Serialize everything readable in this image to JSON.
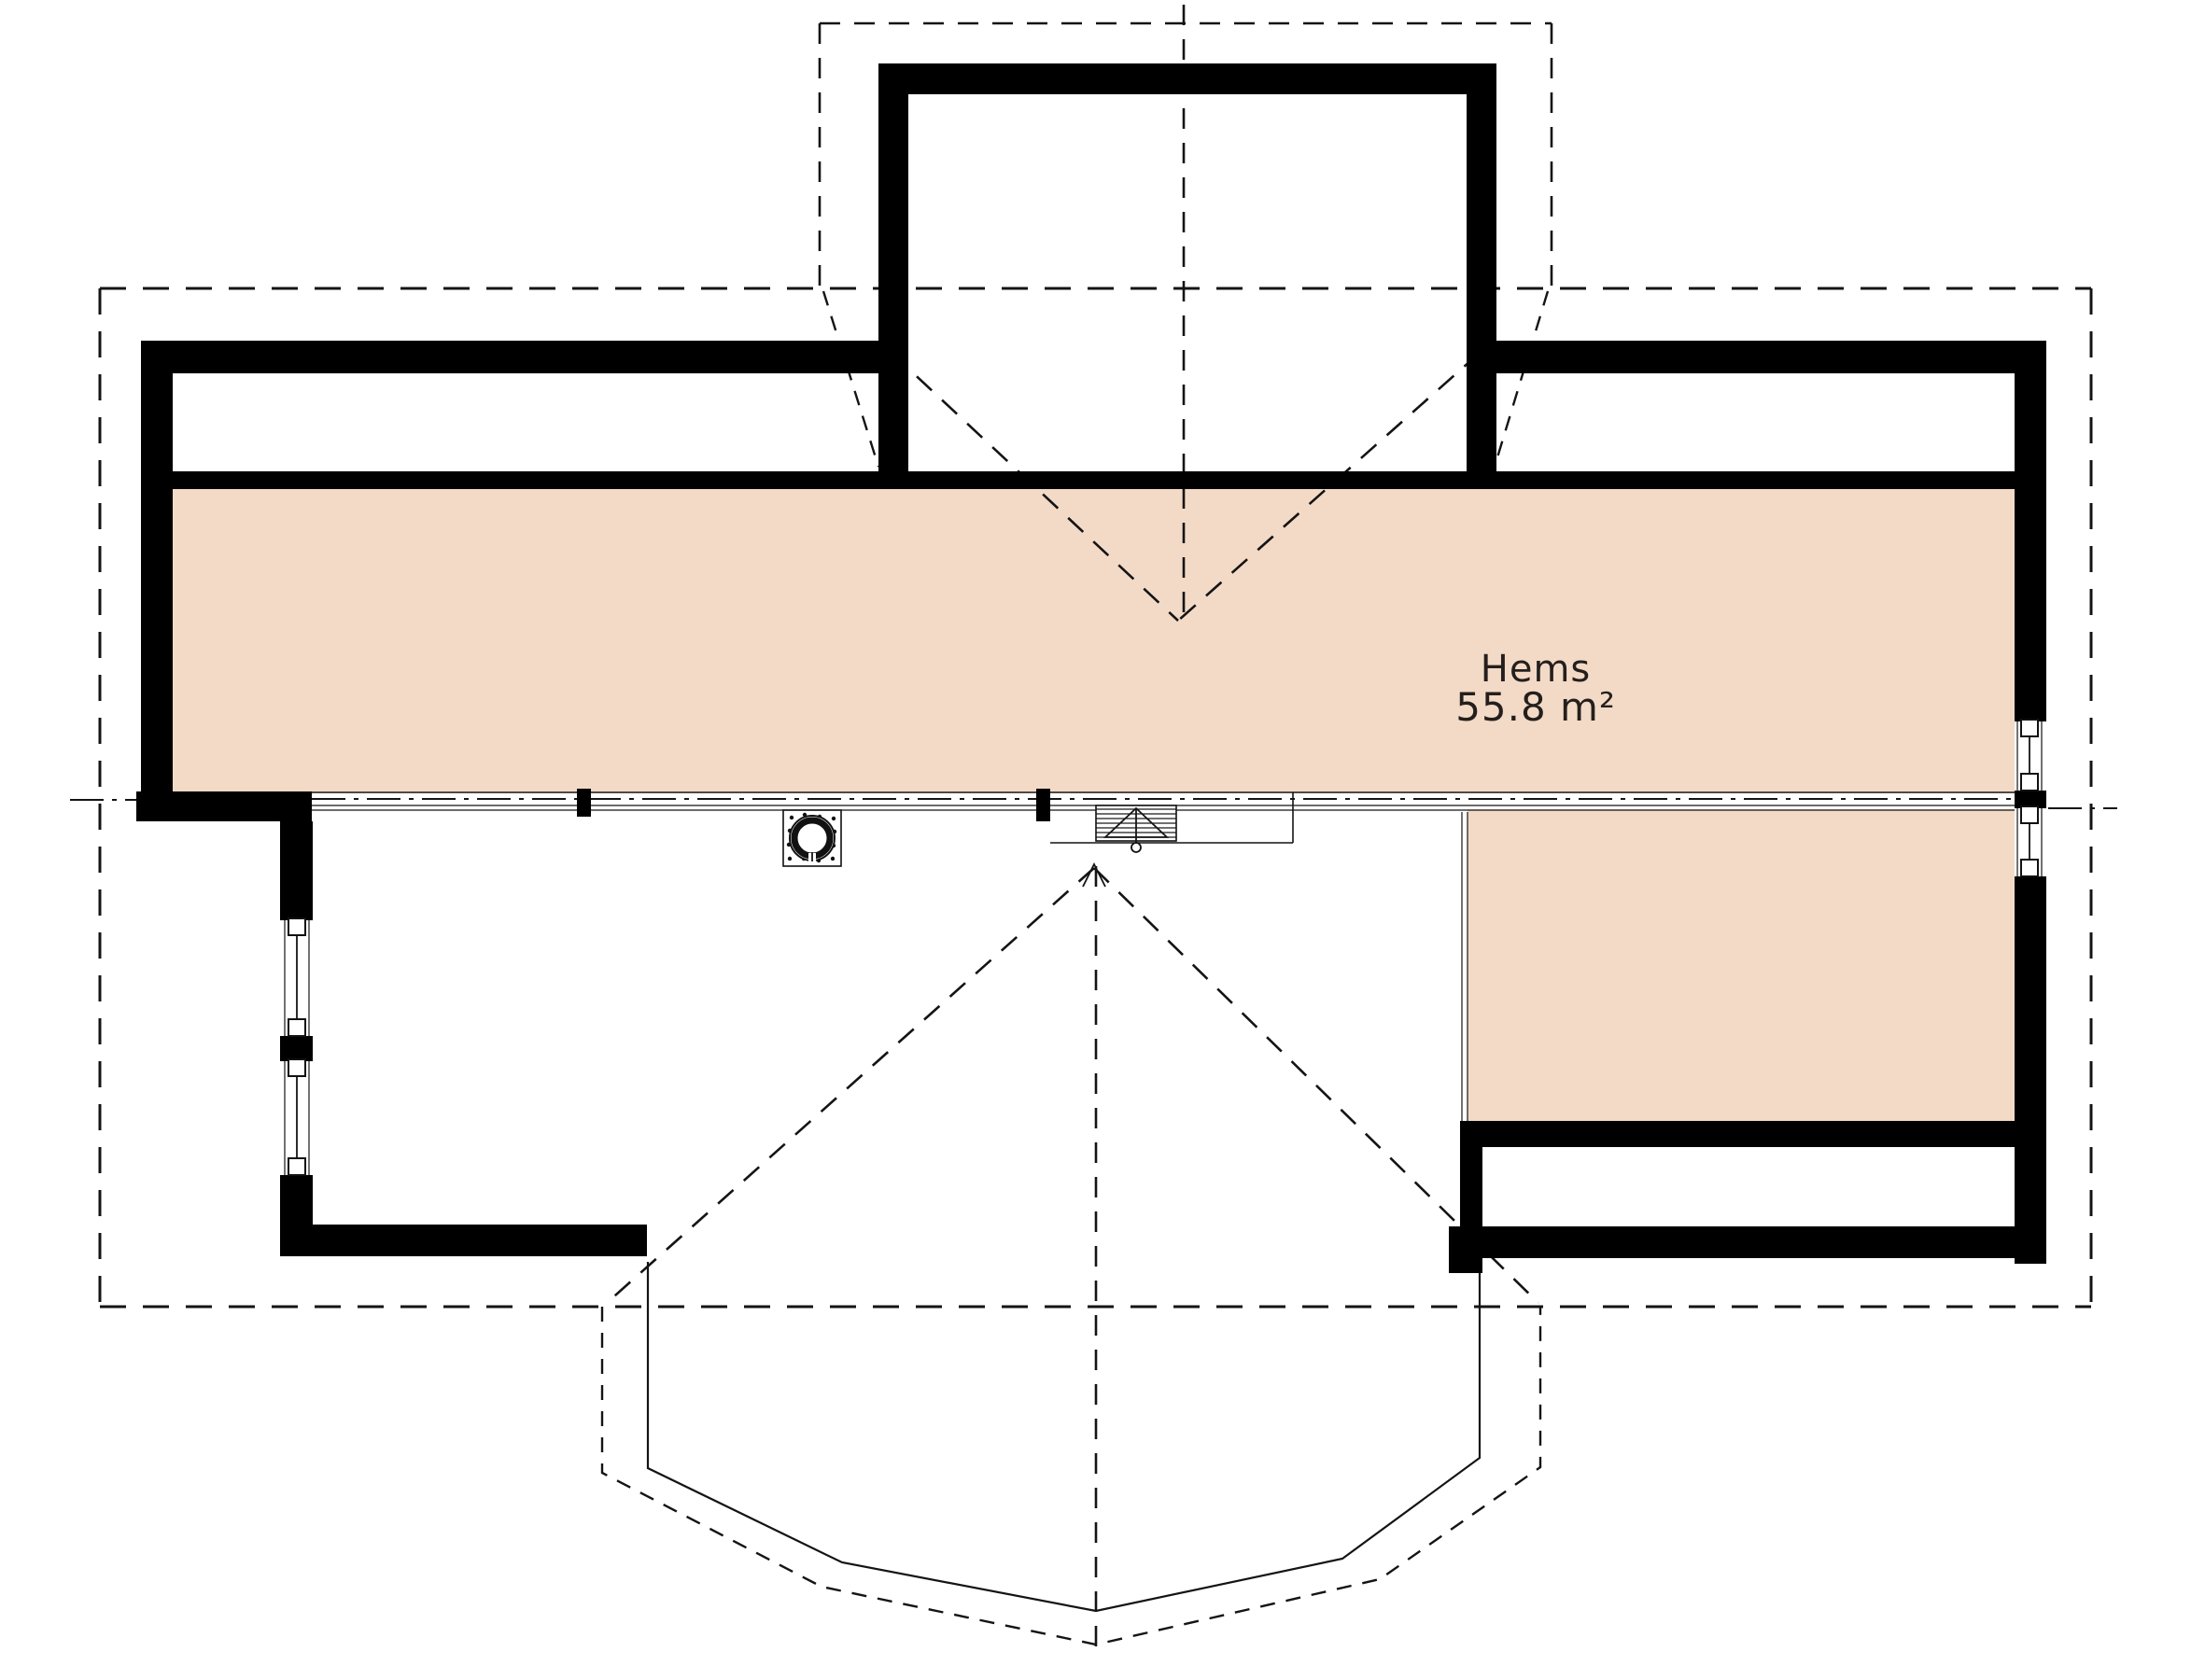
{
  "drawing": {
    "type": "attic floor plan",
    "room_label": {
      "name": "Hems",
      "area": "55.8 m²"
    },
    "colors": {
      "loft_fill": "#f3dac6",
      "wall": "#000000",
      "line": "#141414",
      "background": "#ffffff"
    },
    "icons": [
      "chimney-icon",
      "attic-ladder-icon",
      "window-icon",
      "bay-window-outline",
      "dormer-outline",
      "roof-ridge-lines"
    ]
  }
}
